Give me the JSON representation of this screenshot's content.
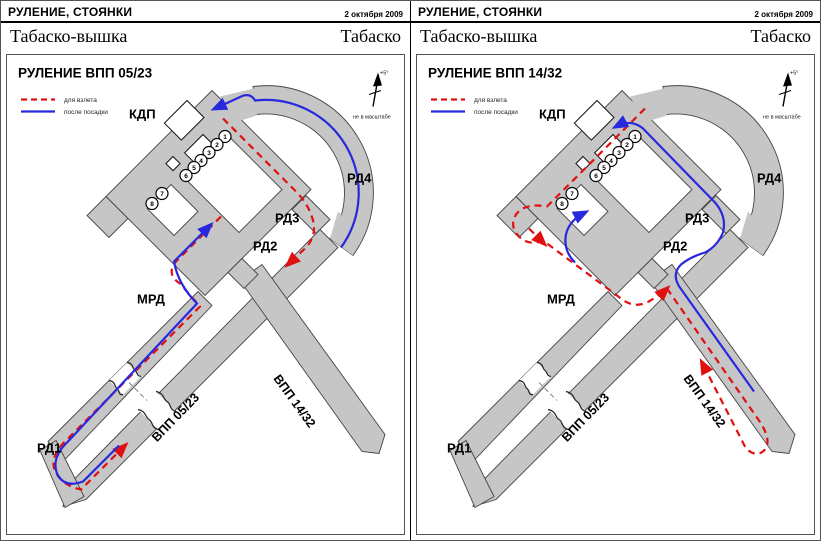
{
  "document": {
    "colors": {
      "takeoff_route": "#e01010",
      "landing_route": "#2828dd",
      "pavement": "#c6c6c6"
    },
    "panels": [
      {
        "header_title": "РУЛЕНИЕ, СТОЯНКИ",
        "date": "2 октября 2009",
        "station": "Табаско-вышка",
        "callsign": "Табаско",
        "title": "РУЛЕНИЕ ВПП 05/23",
        "legend": {
          "takeoff": "для взлета",
          "landing": "после посадки"
        },
        "labels": {
          "kdp": "КДП",
          "rd1": "РД1",
          "rd2": "РД2",
          "rd3": "РД3",
          "rd4": "РД4",
          "mrd": "МРД",
          "rwy_0523": "ВПП 05/23",
          "rwy_1432": "ВПП 14/32"
        },
        "north": {
          "declination": "+5°",
          "note": "не в масштабе"
        },
        "stands": [
          "1",
          "2",
          "3",
          "4",
          "5",
          "6",
          "7",
          "8"
        ]
      },
      {
        "header_title": "РУЛЕНИЕ, СТОЯНКИ",
        "date": "2 октября 2009",
        "station": "Табаско-вышка",
        "callsign": "Табаско",
        "title": "РУЛЕНИЕ ВПП 14/32",
        "legend": {
          "takeoff": "для взлета",
          "landing": "после посадки"
        },
        "labels": {
          "kdp": "КДП",
          "rd1": "РД1",
          "rd2": "РД2",
          "rd3": "РД3",
          "rd4": "РД4",
          "mrd": "МРД",
          "rwy_0523": "ВПП 05/23",
          "rwy_1432": "ВПП 14/32"
        },
        "north": {
          "declination": "+5°",
          "note": "не в масштабе"
        },
        "stands": [
          "1",
          "2",
          "3",
          "4",
          "5",
          "6",
          "7",
          "8"
        ]
      }
    ]
  }
}
